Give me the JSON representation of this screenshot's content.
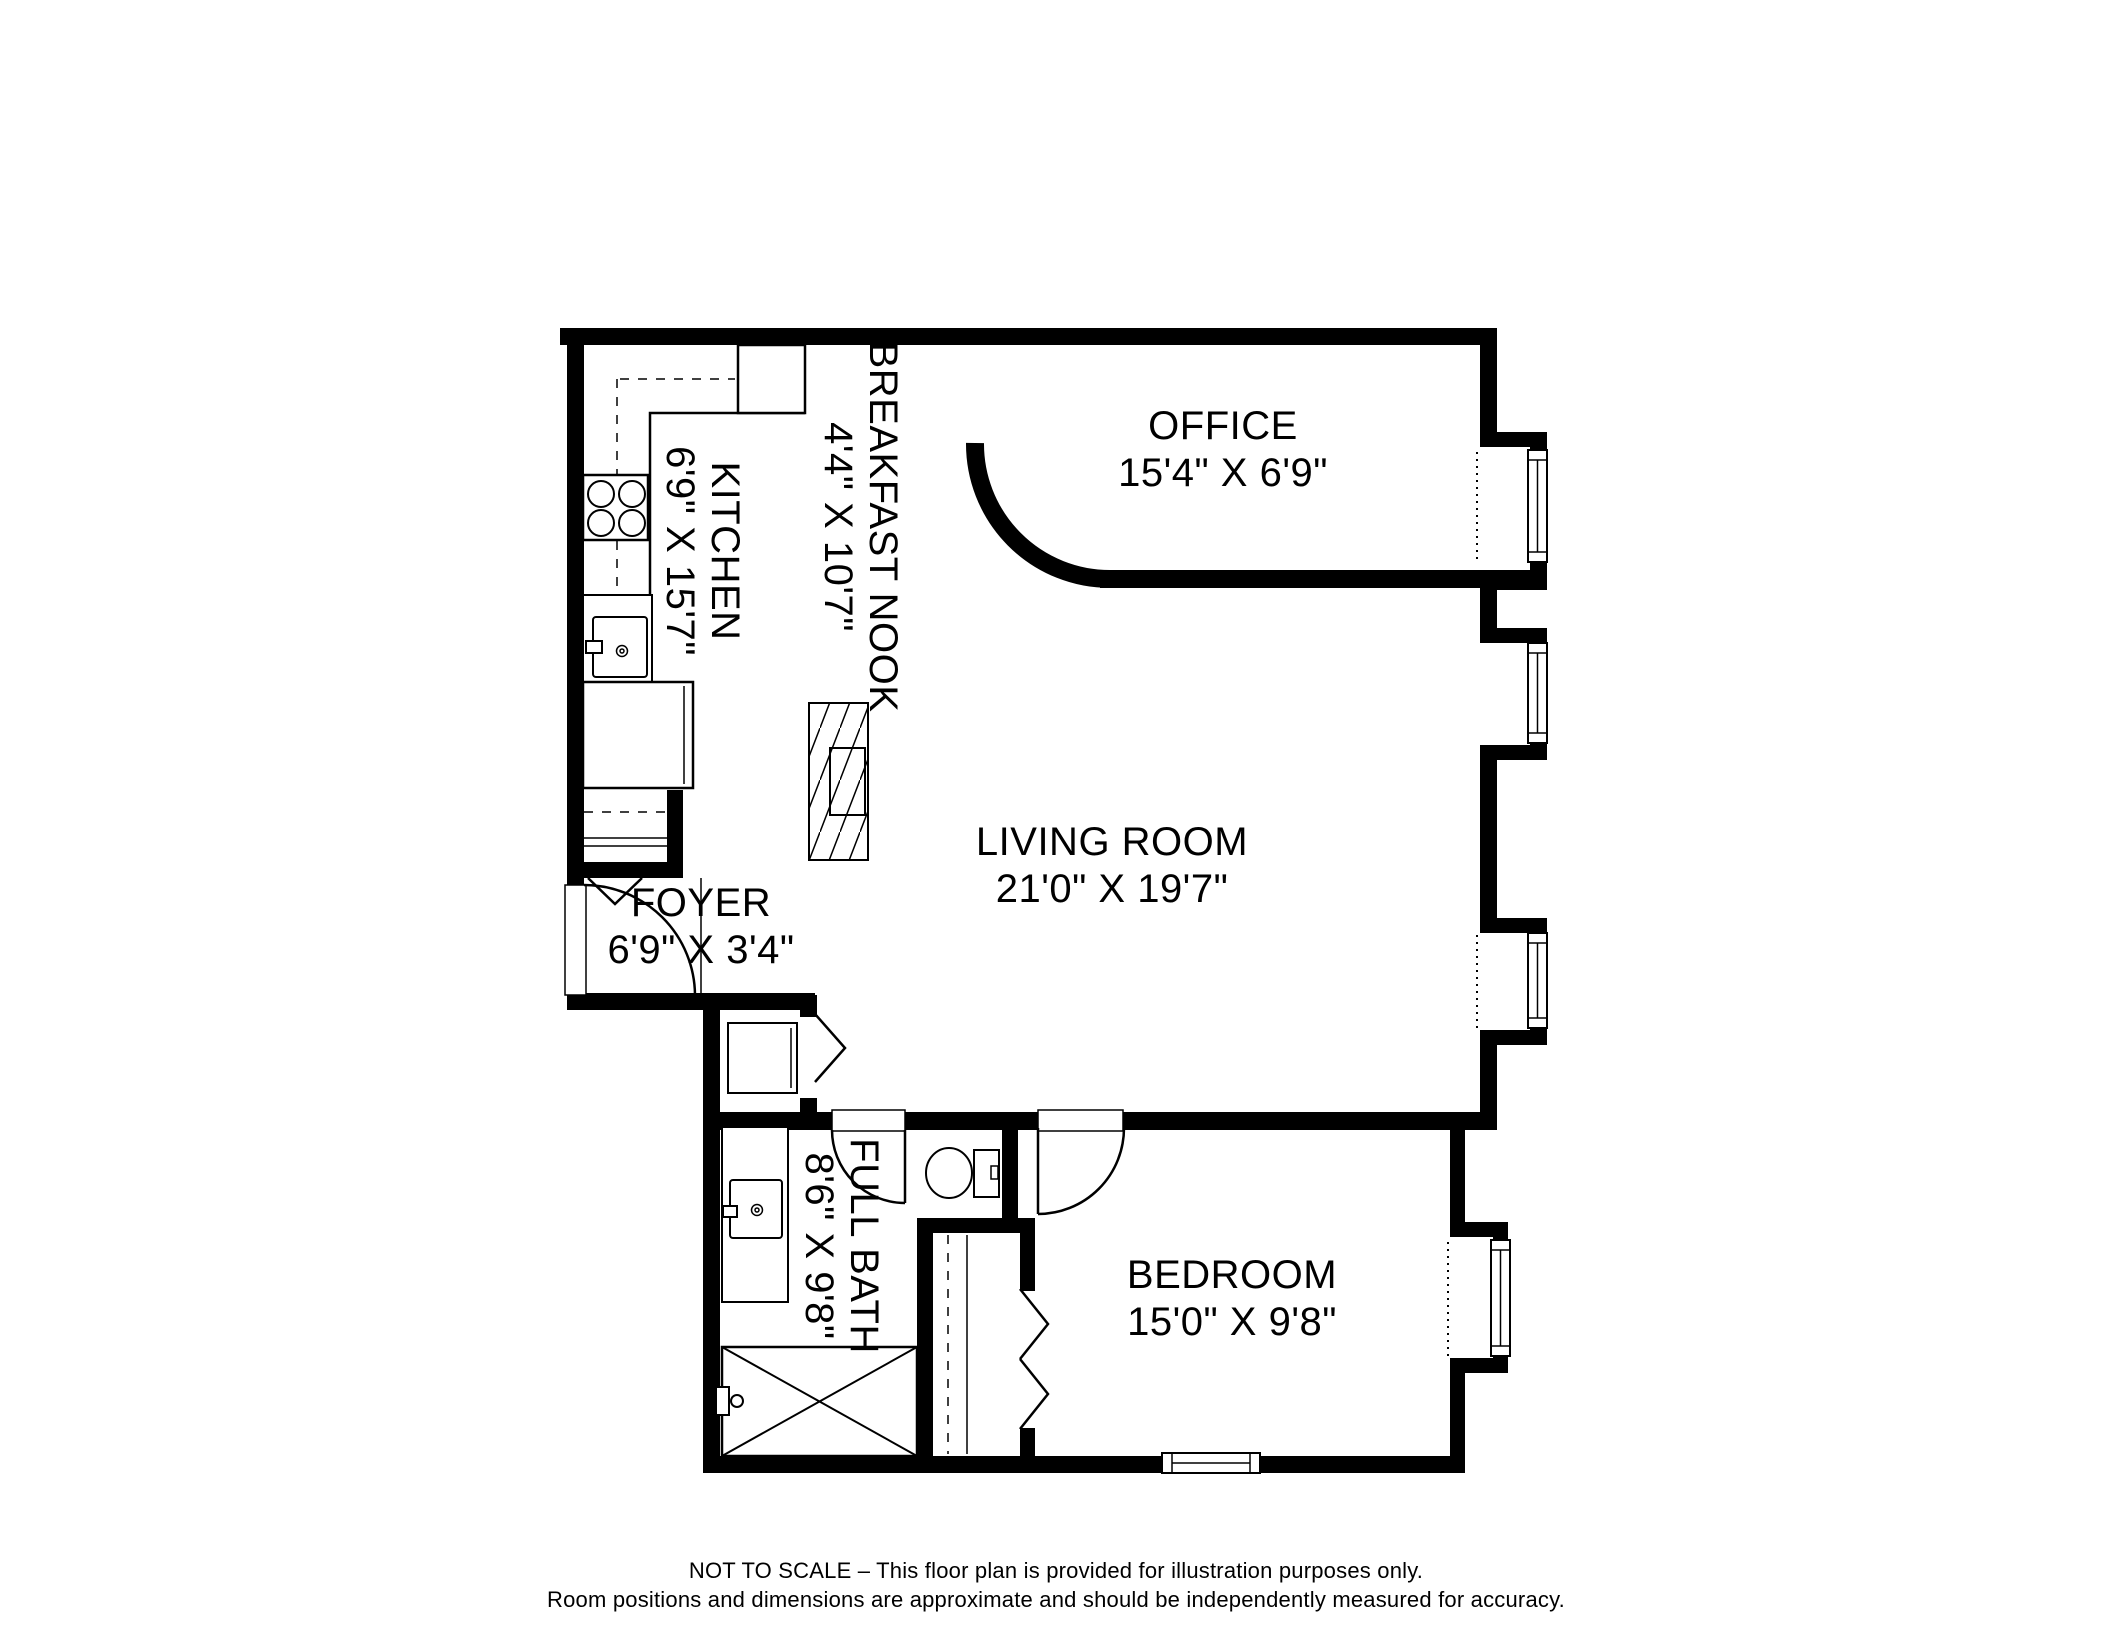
{
  "floor_plan": {
    "colors": {
      "walls": "#000000",
      "background": "#ffffff",
      "text": "#000000"
    },
    "rooms": [
      {
        "name": "OFFICE",
        "dimensions": "15'4\" X 6'9\"",
        "orientation": "horizontal"
      },
      {
        "name": "BREAKFAST NOOK",
        "dimensions": "4'4\" X 10'7\"",
        "orientation": "vertical"
      },
      {
        "name": "KITCHEN",
        "dimensions": "6'9\" X 15'7\"",
        "orientation": "vertical"
      },
      {
        "name": "LIVING ROOM",
        "dimensions": "21'0\" X 19'7\"",
        "orientation": "horizontal"
      },
      {
        "name": "FOYER",
        "dimensions": "6'9\" X 3'4\"",
        "orientation": "horizontal"
      },
      {
        "name": "FULL BATH",
        "dimensions": "8'6\" X 9'8\"",
        "orientation": "vertical"
      },
      {
        "name": "BEDROOM",
        "dimensions": "15'0\" X 9'8\"",
        "orientation": "horizontal"
      }
    ],
    "fixtures": [
      "stove-icon",
      "kitchen-sink-icon",
      "refrigerator-icon",
      "island-counter-icon",
      "coat-closet",
      "utility-closet",
      "vanity-sink-icon",
      "toilet-icon",
      "bathtub-icon",
      "bedroom-closet",
      "window",
      "door-swing"
    ],
    "disclaimer": {
      "line1": "NOT TO SCALE – This floor plan is provided for illustration purposes only.",
      "line2": "Room positions and dimensions are approximate and should be independently measured for accuracy."
    }
  }
}
